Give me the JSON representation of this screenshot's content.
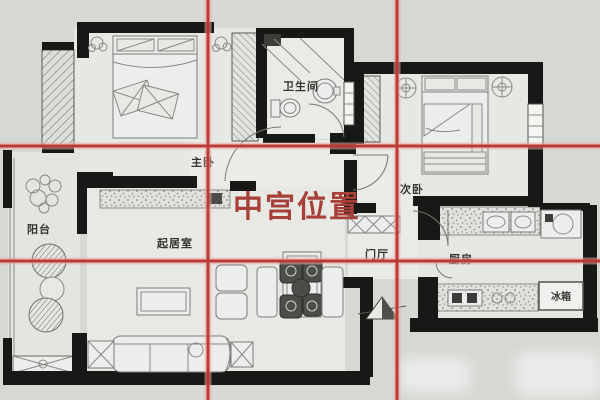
{
  "overlay": {
    "center_label": "中宫位置",
    "center_label_color": "#a8403a",
    "grid": {
      "type": "nine-palace 3x3 grid",
      "line_color": "#bc3a33",
      "halo_color": "#e9a8a2",
      "vertical_lines_x": [
        208,
        397
      ],
      "horizontal_lines_y": [
        146,
        261
      ]
    }
  },
  "rooms": {
    "master_bedroom": {
      "label": "主卧"
    },
    "bathroom": {
      "label": "卫生间"
    },
    "second_bedroom": {
      "label": "次卧"
    },
    "balcony": {
      "label": "阳台"
    },
    "living_room": {
      "label": "起居室"
    },
    "hallway": {
      "label": "门厅"
    },
    "kitchen": {
      "label": "厨房"
    },
    "fridge": {
      "label": "冰箱"
    }
  },
  "colors": {
    "background": "#d6d8d4",
    "floor": "#e7e8e4",
    "walls": "#181816",
    "label_text": "#34342f"
  },
  "icons": {
    "north_arrow": "north-arrow-icon"
  }
}
